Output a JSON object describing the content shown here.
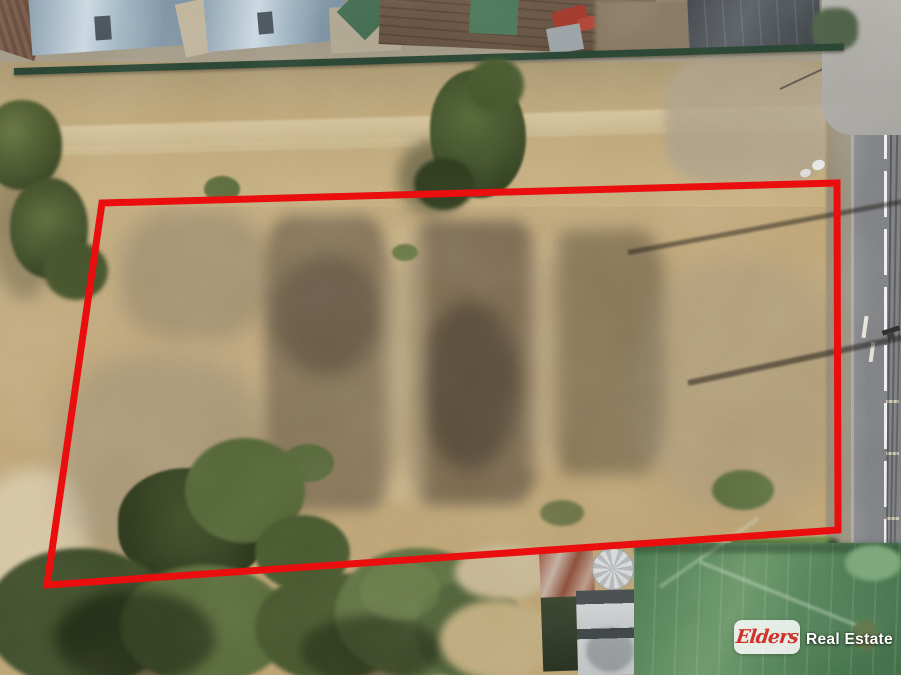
{
  "scene": {
    "type": "aerial-drone-photo",
    "description": "Top-down aerial photograph of a large vacant dry-grass land parcel outlined with a red boundary, bordered by residential houses at top and bottom, dense trees at the lower left, and a sealed road with power lines on the right."
  },
  "boundary": {
    "color": "#ea0e0e",
    "stroke_width": 7,
    "points": "102,203 837,183 838,530 47,585"
  },
  "watermark": {
    "brand": "Elders",
    "suffix": "Real Estate",
    "brand_color": "#cf332a",
    "box_color": "rgba(255,255,255,0.84)"
  }
}
